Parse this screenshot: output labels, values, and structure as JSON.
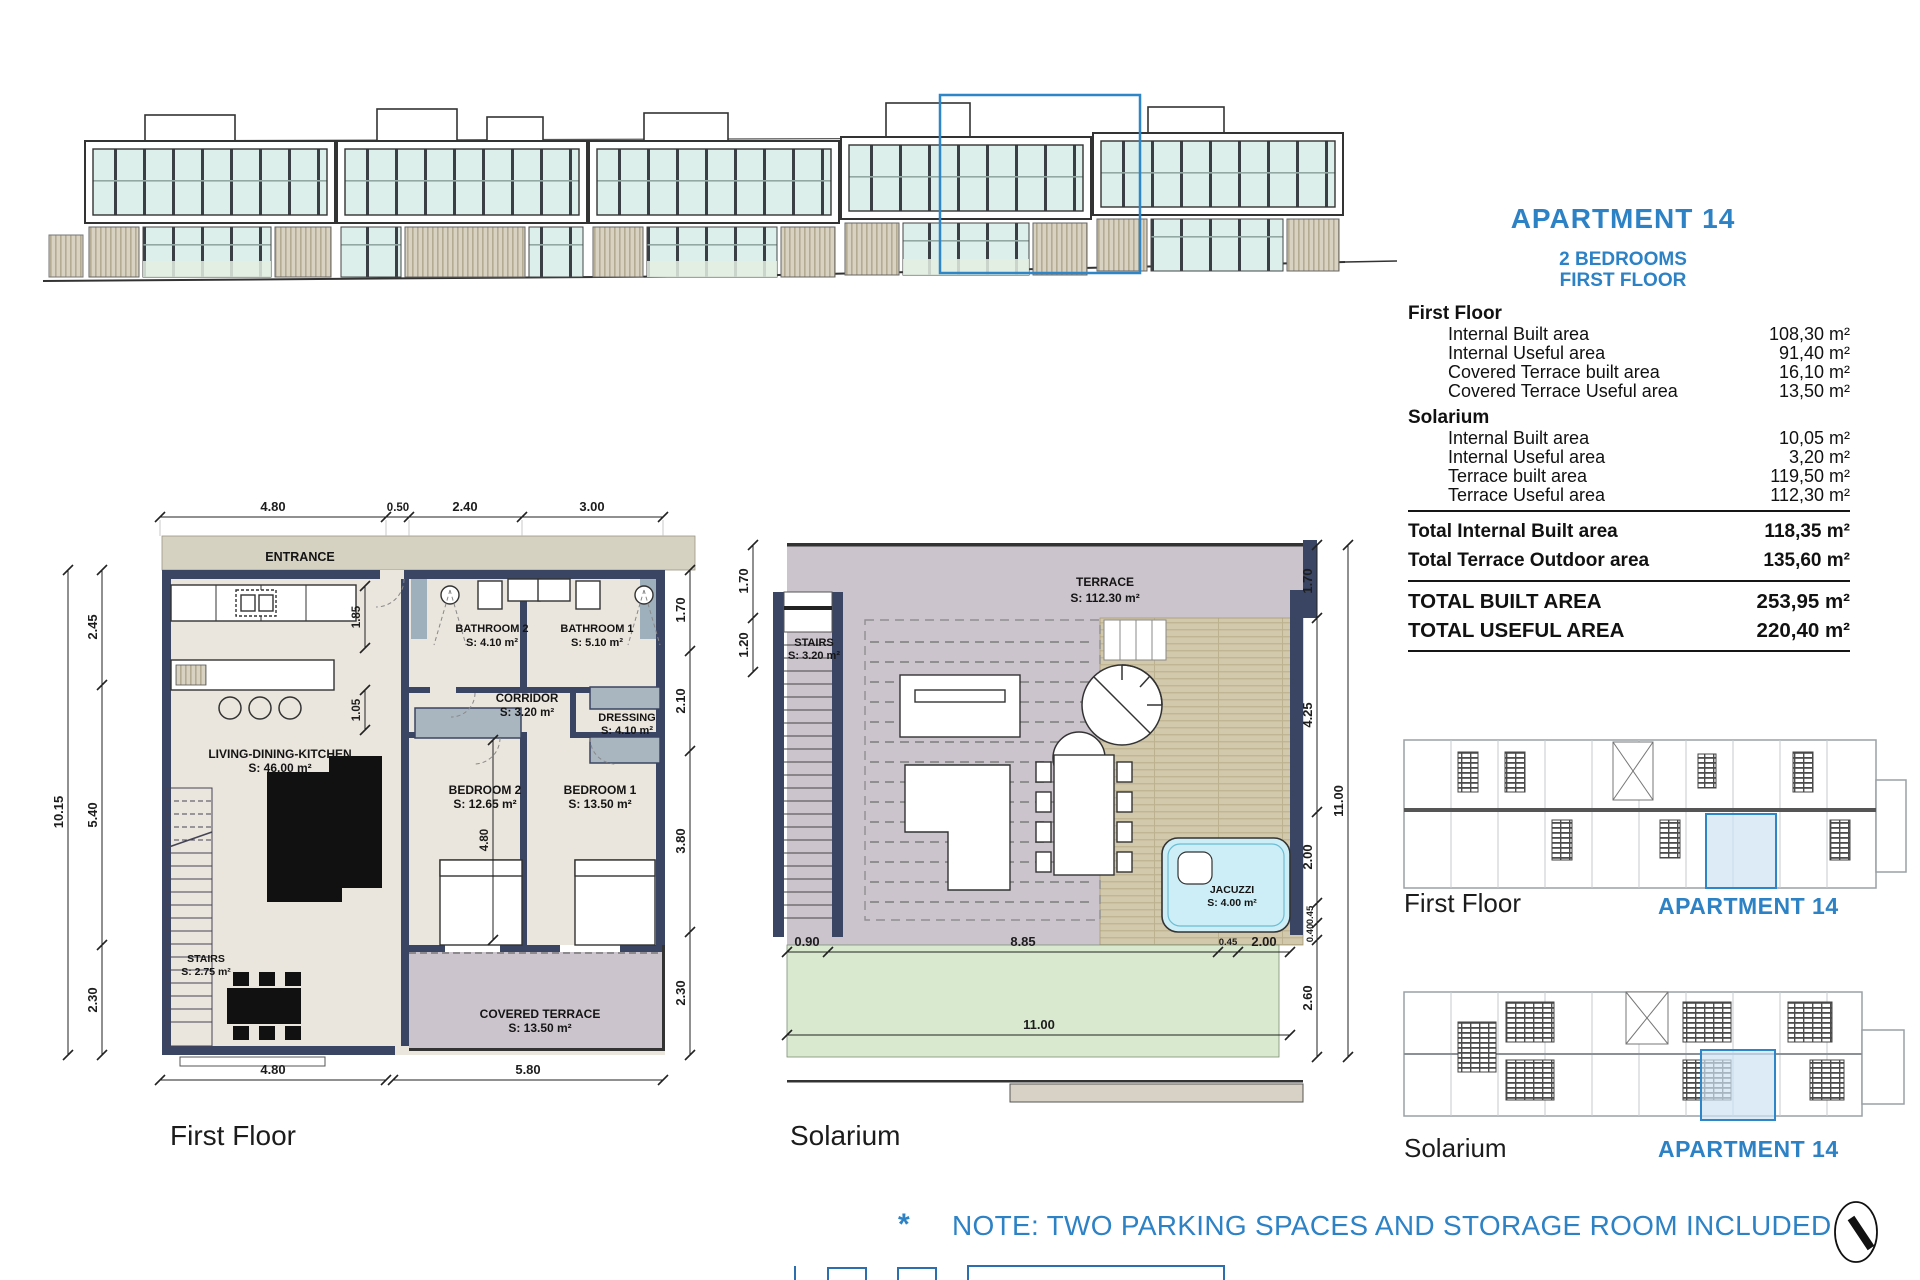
{
  "header": {
    "title": "APARTMENT  14",
    "subtitle1": "2 BEDROOMS",
    "subtitle2": "FIRST FLOOR"
  },
  "area_table": {
    "sections": [
      {
        "header": "First Floor",
        "rows": [
          {
            "label": "Internal Built area",
            "value": "108,30 m²"
          },
          {
            "label": "Internal Useful area",
            "value": "91,40 m²"
          },
          {
            "label": "Covered Terrace built area",
            "value": "16,10 m²"
          },
          {
            "label": "Covered Terrace Useful area",
            "value": "13,50 m²"
          }
        ]
      },
      {
        "header": "Solarium",
        "rows": [
          {
            "label": "Internal Built area",
            "value": "10,05 m²"
          },
          {
            "label": "Internal Useful area",
            "value": "3,20 m²"
          },
          {
            "label": "Terrace built area",
            "value": "119,50 m²"
          },
          {
            "label": "Terrace Useful area",
            "value": "112,30 m²"
          }
        ]
      }
    ],
    "subtotals": [
      {
        "label": "Total Internal Built area",
        "value": "118,35 m²"
      },
      {
        "label": "Total Terrace Outdoor area",
        "value": "135,60 m²"
      }
    ],
    "totals": [
      {
        "label": "TOTAL BUILT AREA",
        "value": "253,95 m²"
      },
      {
        "label": "TOTAL USEFUL AREA",
        "value": "220,40 m²"
      }
    ]
  },
  "first_floor": {
    "caption": "First Floor",
    "entrance": "ENTRANCE",
    "rooms": {
      "living": {
        "name": "LIVING-DINING-KITCHEN",
        "area": "S: 46.00 m²"
      },
      "bathroom2": {
        "name": "BATHROOM 2",
        "area": "S: 4.10 m²"
      },
      "bathroom1": {
        "name": "BATHROOM 1",
        "area": "S: 5.10 m²"
      },
      "corridor": {
        "name": "CORRIDOR",
        "area": "S: 3.20 m²"
      },
      "dressing": {
        "name": "DRESSING",
        "area": "S: 4.10 m²"
      },
      "bedroom2": {
        "name": "BEDROOM 2",
        "area": "S: 12.65 m²"
      },
      "bedroom1": {
        "name": "BEDROOM 1",
        "area": "S: 13.50 m²"
      },
      "stairs": {
        "name": "STAIRS",
        "area": "S: 2.75 m²"
      },
      "terrace": {
        "name": "COVERED TERRACE",
        "area": "S: 13.50 m²"
      }
    },
    "dims": {
      "top": [
        "4.80",
        "0.50",
        "2.40",
        "3.00"
      ],
      "left_total": "10.15",
      "left": [
        "2.45",
        "5.40",
        "2.30"
      ],
      "right": [
        "1.70",
        "2.10",
        "3.80",
        "2.30"
      ],
      "bottom": [
        "4.80",
        "5.80"
      ],
      "inner": [
        "1.85",
        "1.05",
        "4.80"
      ]
    }
  },
  "solarium": {
    "caption": "Solarium",
    "rooms": {
      "terrace": {
        "name": "TERRACE",
        "area": "S: 112.30 m²"
      },
      "stairs": {
        "name": "STAIRS",
        "area": "S: 3.20 m²"
      },
      "jacuzzi": {
        "name": "JACUZZI",
        "area": "S: 4.00 m²"
      }
    },
    "dims": {
      "left": [
        "1.70",
        "1.20"
      ],
      "right": [
        "1.70",
        "4.25",
        "2.00",
        "0.45",
        "0.40",
        "2.60"
      ],
      "right_total": "11.00",
      "bottom": [
        "0.90",
        "8.85",
        "0.45",
        "2.00"
      ],
      "bottom_total": "11.00"
    }
  },
  "key_plans": [
    {
      "caption": "First Floor",
      "highlight": "APARTMENT 14"
    },
    {
      "caption": "Solarium",
      "highlight": "APARTMENT 14"
    }
  ],
  "note": {
    "marker": "*",
    "text": "NOTE:  TWO PARKING SPACES AND STORAGE ROOM INCLUDED"
  },
  "colors": {
    "accent_blue": "#2d82c6",
    "highlight_stroke": "#2e86c8",
    "highlight_fill": "#cfe2f4",
    "wall_navy": "#3a4563",
    "floor_beige": "#eae6dd",
    "entrance_tan": "#d6d2c2",
    "terrace_mauve": "#cbc4cc",
    "deck_tan": "#d2c8ac",
    "lawn_green": "#d9e9cf",
    "jacuzzi_blue": "#cdeef6",
    "glass_teal": "#dcefeb"
  }
}
